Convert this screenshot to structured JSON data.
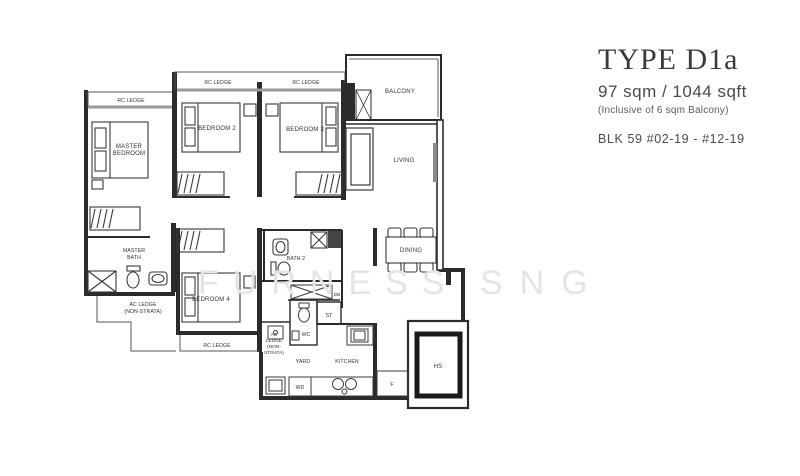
{
  "title_block": {
    "type_label": "TYPE D1a",
    "area": "97 sqm / 1044 sqft",
    "balcony_note": "(Inclusive of 6 sqm Balcony)",
    "block_units": "BLK 59   #02-19 - #12-19"
  },
  "watermark": {
    "part1": "FURNESS",
    "part2": "SNG"
  },
  "plan": {
    "labels": {
      "rc_ledge_master": "RC LEDGE",
      "rc_ledge_bed2": "RC LEDGE",
      "rc_ledge_bed3": "RC LEDGE",
      "rc_ledge_bottom": "RC LEDGE",
      "master_bedroom_line1": "MASTER",
      "master_bedroom_line2": "BEDROOM",
      "bedroom2": "BEDROOM 2",
      "bedroom3": "BEDROOM 3",
      "bedroom4": "BEDROOM 4",
      "balcony": "BALCONY",
      "living": "LIVING",
      "dining": "DINING",
      "master_bath_line1": "MASTER",
      "master_bath_line2": "BATH",
      "bath2": "BATH 2",
      "ac_ledge_left_line1": "AC LEDGE",
      "ac_ledge_left_line2": "(NON-STRATA)",
      "ac_ledge_mid_line1": "AC",
      "ac_ledge_mid_line2": "LEDGE",
      "ac_ledge_mid_line3": "(NON-",
      "ac_ledge_mid_line4": "STRATA)",
      "db": "DB",
      "st": "ST",
      "wc": "WC",
      "yard": "YARD",
      "kitchen": "KITCHEN",
      "wd": "WD",
      "fridge": "F",
      "hs": "HS"
    }
  },
  "colors": {
    "wall": "#2b2b2b",
    "window_gray": "#9a9a9a",
    "curtain_gray": "#8a8a8a",
    "watermark_gray": "#e4e4e4",
    "title_text": "#3a3a3a"
  }
}
